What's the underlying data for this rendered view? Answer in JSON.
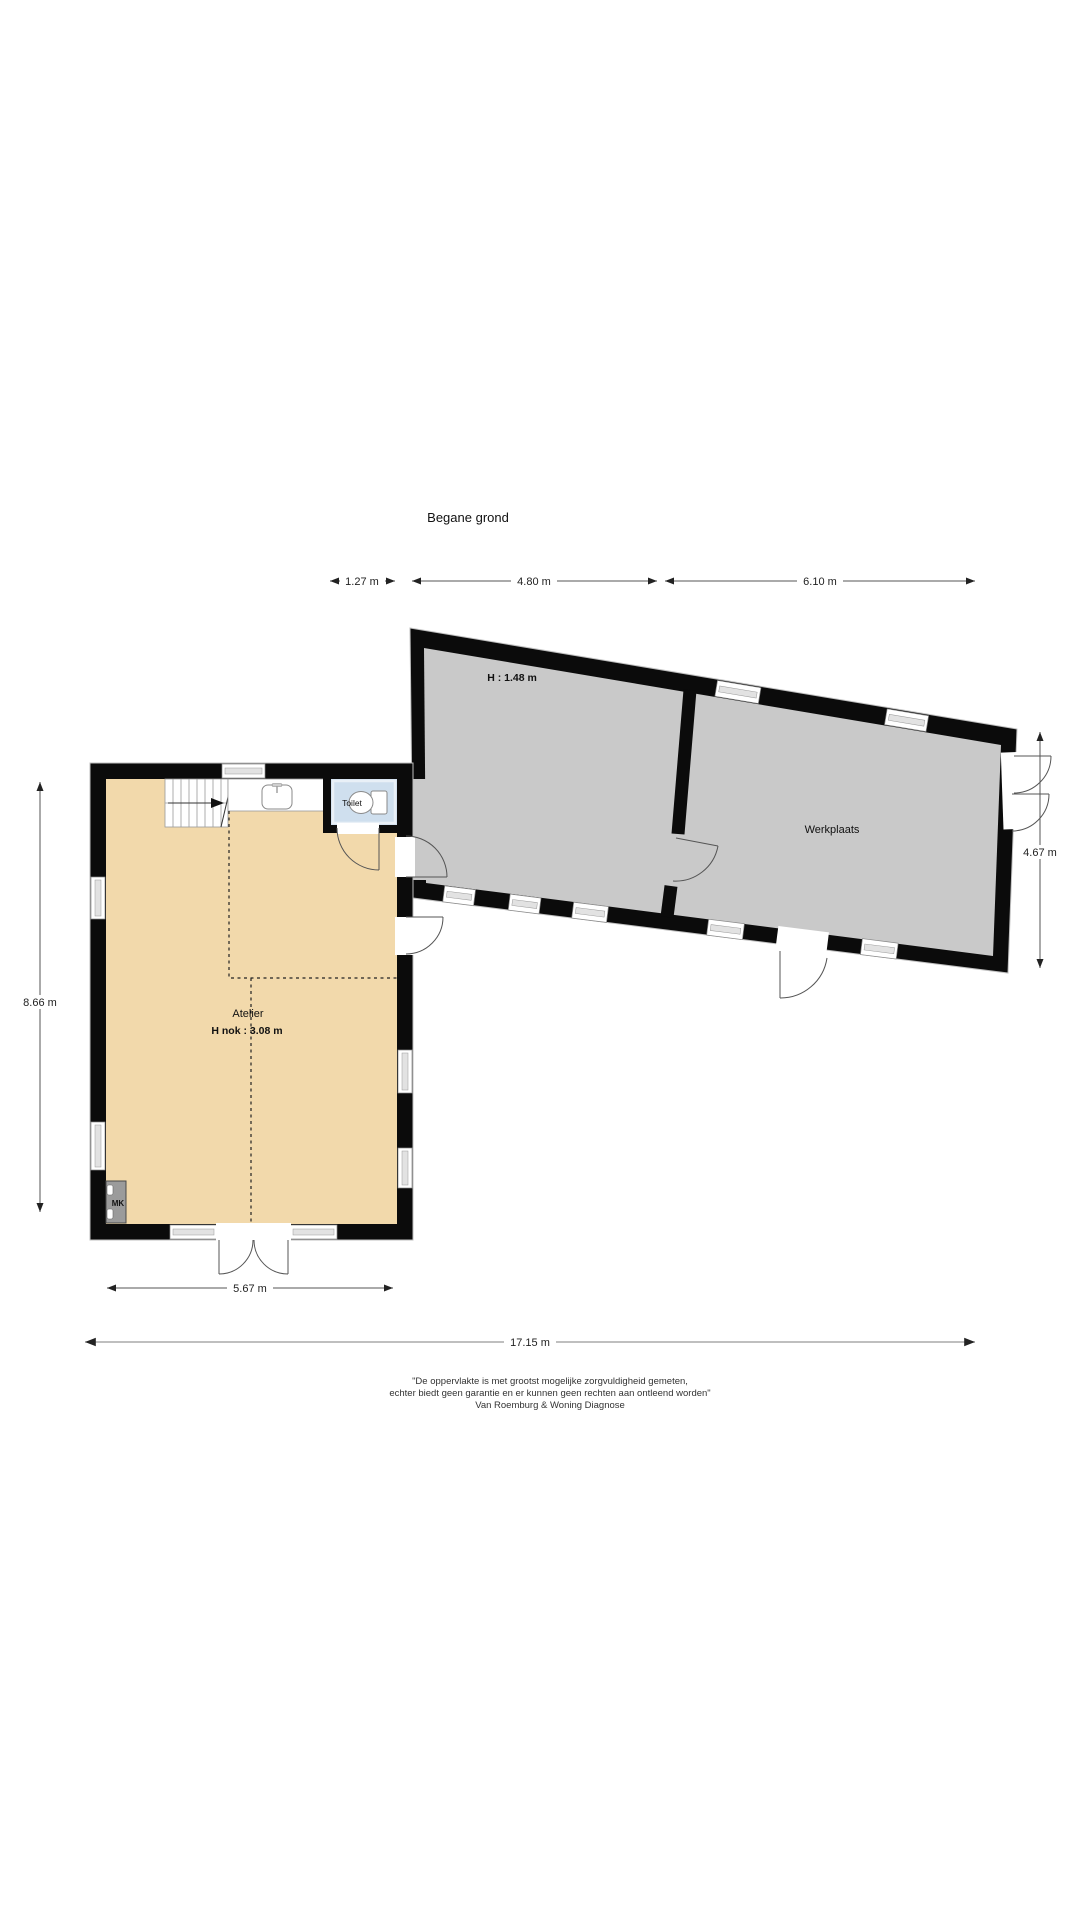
{
  "title": "Begane grond",
  "dims": {
    "top": [
      "1.27 m",
      "4.80 m",
      "6.10 m"
    ],
    "left": "8.66 m",
    "right": "4.67 m",
    "bottom_inner": "5.67 m",
    "bottom_total": "17.15 m"
  },
  "rooms": {
    "atelier": {
      "label": "Atelier",
      "height": "H nok : 3.08 m",
      "color": "#F2D9AB"
    },
    "attic": {
      "height": "H : 1.48 m"
    },
    "werkplaats": {
      "label": "Werkplaats",
      "color": "#C9C9C9"
    },
    "toilet": {
      "label": "Toilet",
      "color": "#CFDFEE"
    },
    "mk": {
      "label": "MK",
      "color": "#9B9B9B"
    }
  },
  "colors": {
    "wall": "#0B0B0B",
    "dimension_line": "#555555"
  },
  "footer": {
    "line1": "\"De oppervlakte is met grootst mogelijke zorgvuldigheid gemeten,",
    "line2": "echter biedt geen garantie en er kunnen geen rechten aan ontleend worden\"",
    "line3": "Van Roemburg & Woning Diagnose"
  }
}
